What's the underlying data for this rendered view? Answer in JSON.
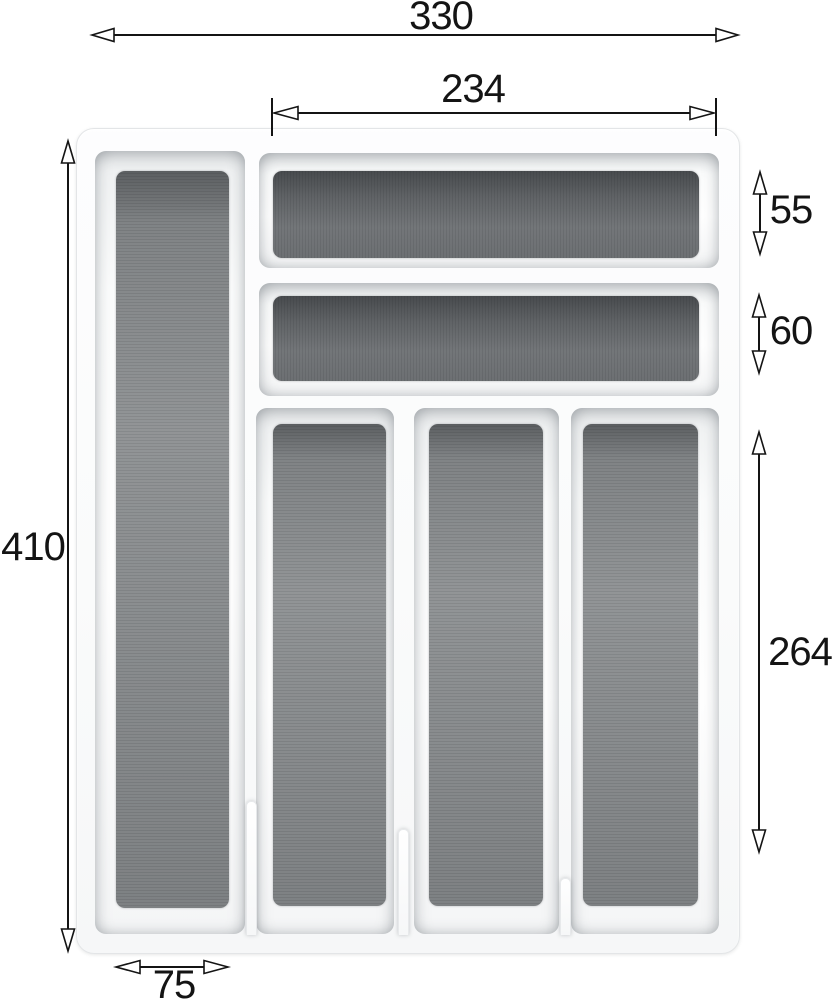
{
  "drawing": {
    "subject": "cutlery-tray-insert-top-view",
    "compartment_count": 6,
    "dimension_labels": {
      "overall_width": "330",
      "inner_top_width": "234",
      "overall_depth": "410",
      "top_slot_height": "55",
      "second_slot_height": "60",
      "vertical_slot_height": "264",
      "left_column_width": "75"
    },
    "colors": {
      "background": "#ffffff",
      "dimension_line": "#141414",
      "tray_white": "#fafbfb",
      "tray_edge": "#e3e5e7",
      "insert_gray": "#878a8c",
      "insert_dark_top": "#5a5d60"
    }
  }
}
